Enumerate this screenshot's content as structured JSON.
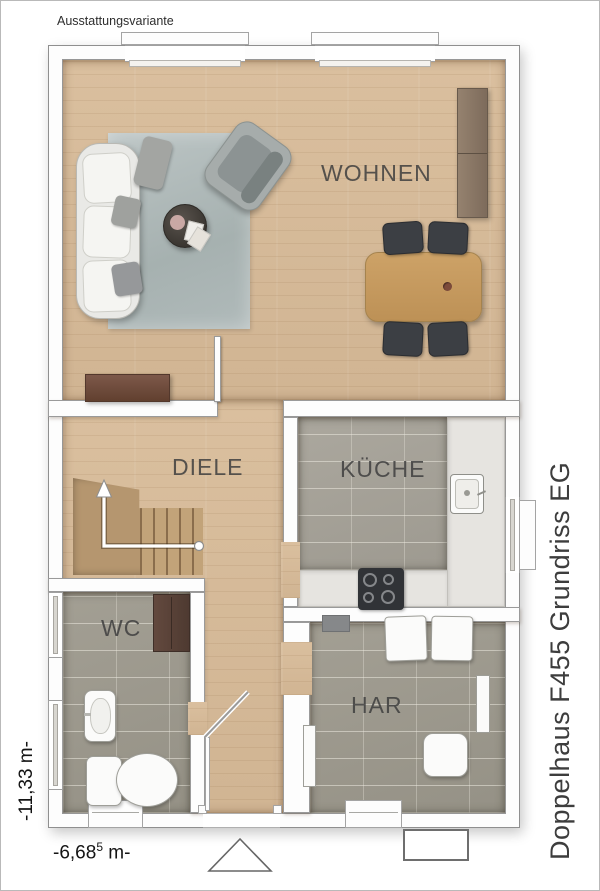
{
  "header": {
    "variant_label": "Ausstattungsvariante"
  },
  "title": {
    "vertical_label": "Doppelhaus F455 Grundriss EG"
  },
  "dims": {
    "height_label": "-11,33 m-",
    "width_prefix": "-6,68",
    "width_sup": "5",
    "width_suffix": " m-"
  },
  "rooms": {
    "wohnen": {
      "label": "WOHNEN"
    },
    "diele": {
      "label": "DIELE"
    },
    "kueche": {
      "label": "KÜCHE"
    },
    "wc": {
      "label": "WC"
    },
    "har": {
      "label": "HAR"
    }
  },
  "icons": [
    "sofa-icon",
    "armchair-icon",
    "rug-icon",
    "coffee-table-icon",
    "dining-table-icon",
    "dining-chair-icon",
    "sideboard-icon",
    "lowboard-icon",
    "stairs-icon",
    "stair-arrow-icon",
    "wardrobe-icon",
    "washbasin-icon",
    "toilet-icon",
    "kitchen-sink-icon",
    "stove-icon",
    "washing-machine-icon",
    "water-tank-icon",
    "radiator-icon",
    "entrance-triangle-icon",
    "door-swing-icon",
    "window-icon"
  ],
  "colors": {
    "wood_floor": "#d8bc9a",
    "tile_floor": "#9d998d",
    "kitchen_tile": "#a6a298",
    "counter": "#e6e4e0",
    "wall": "#fdfdfd",
    "wall_line": "#9a9a9a",
    "stair_wood": "#b5966f",
    "dark_wood_furniture": "#6f4c3e",
    "chair_dark": "#3c3f44",
    "rug": "#b1bbba",
    "label_text": "#3f3f3f"
  }
}
